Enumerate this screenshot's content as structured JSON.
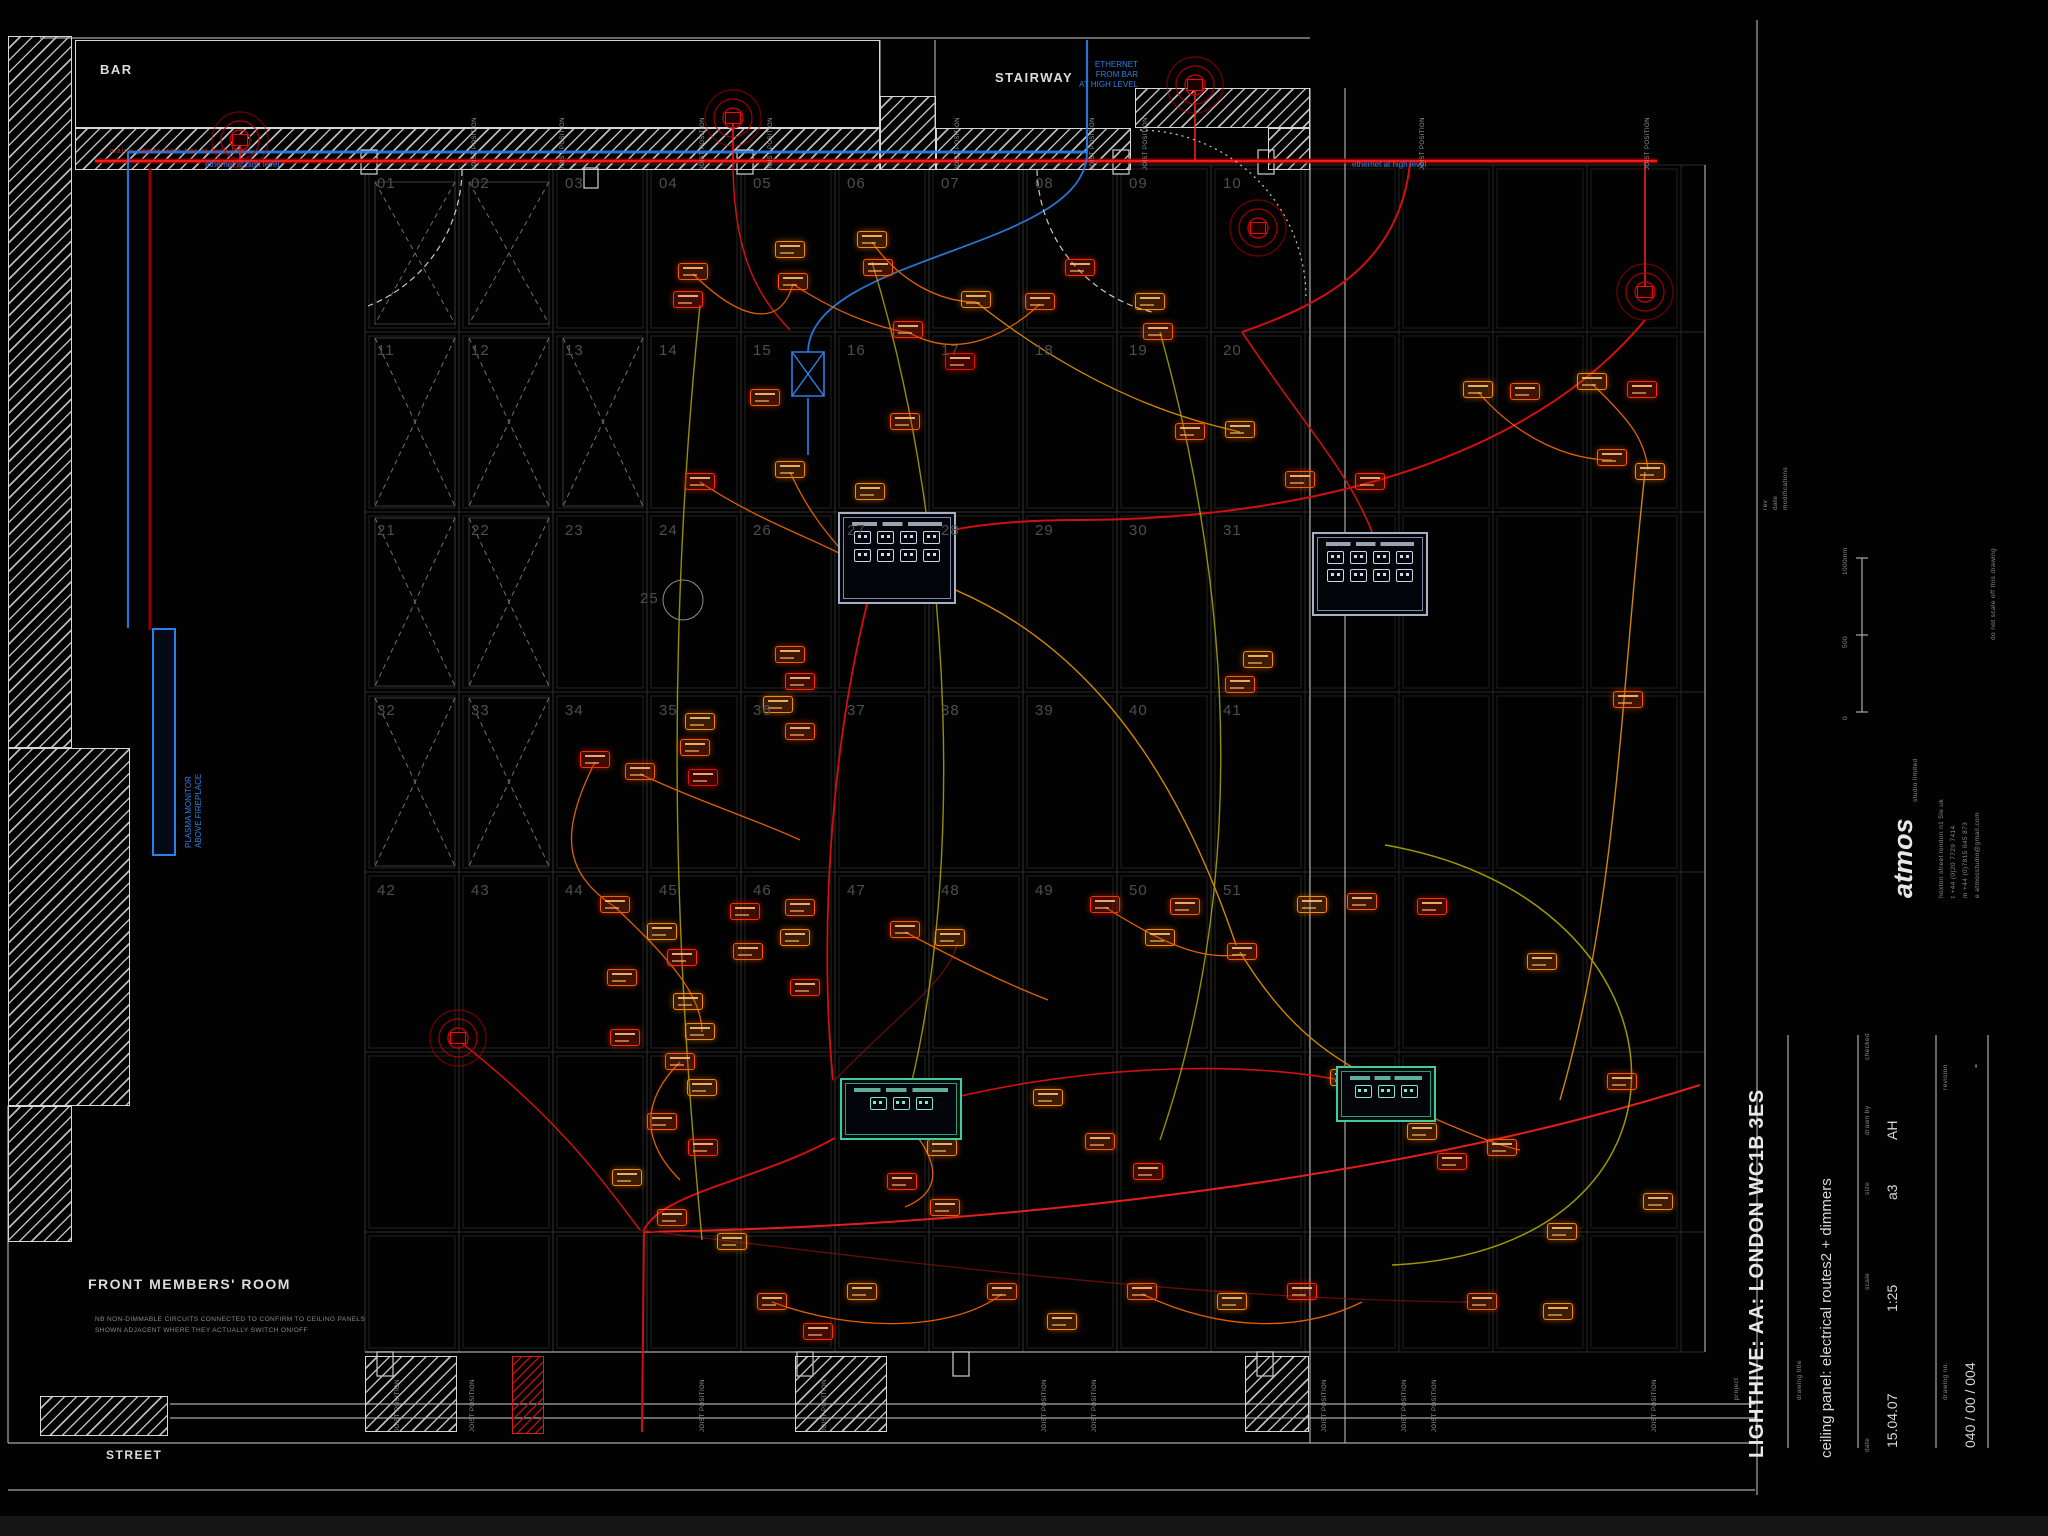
{
  "labels": {
    "bar": "BAR",
    "stairway": "STAIRWAY",
    "street": "STREET",
    "front_room": "FRONT MEMBERS' ROOM",
    "front_note1": "NB NON-DIMMABLE CIRCUITS CONNECTED TO CONFIRM TO CEILING PANELS",
    "front_note2": "SHOWN ADJACENT WHERE THEY ACTUALLY SWITCH ON/OFF",
    "plasma1": "PLASMA MONITOR",
    "plasma2": "ABOVE FIREPLACE",
    "eth_block": [
      "ETHERNET",
      "FROM BAR",
      "AT HIGH LEVEL"
    ],
    "eth_left": "ethernet at high level",
    "eth_right": "ethernet at high level",
    "mains_note": "mains power from bar at high level",
    "joist": "JOIST POSITION",
    "panel_25": "25"
  },
  "title_block": {
    "project_label": "project",
    "project": "LIGHTHIVE: AA: LONDON WC1B 3ES",
    "drawing_title_label": "drawing title",
    "drawing_title": "ceiling panel: electrical routes2 + dimmers",
    "date_label": "date",
    "date": "15.04.07",
    "scale_label": "scale",
    "scale": "1:25",
    "size_label": "size",
    "size": "a3",
    "drawn_label": "drawn by",
    "drawn": "AH",
    "checked_label": "checked",
    "checked": "",
    "drawing_no_label": "drawing no.",
    "drawing_no": "040 / 00 / 004",
    "revision_label": "revision",
    "revision": "-",
    "no_scale_note": "do not scale off this drawing",
    "margin_rev": "rev",
    "margin_date": "date",
    "margin_mods": "modifications",
    "logo_name": "atmos",
    "logo_sub": "studio limited",
    "logo_line1": "hoxton street  london  n1 5le  uk",
    "logo_line2": "t  +44 (0)20 7729 7414",
    "logo_line3": "m +44 (0)7815 045 873",
    "logo_line4": "e  atmosstudio@gmail.com",
    "scalebar_0": "0",
    "scalebar_500": "500",
    "scalebar_1000": "1000mm"
  },
  "palette": {
    "redMain": "#a00000",
    "redBright": "#ff2020",
    "red": "#d01010",
    "darkred": "#7a1010",
    "orange": "#e06000",
    "amber": "#d08800",
    "yellow": "#b0a800",
    "blue": "#2d7fe8",
    "dashWhite": "#c8c8c8"
  },
  "grid": {
    "x0": 365,
    "col_w": 94,
    "cols": 10,
    "row_ys": [
      165,
      332,
      512,
      692,
      872,
      1052,
      1232
    ],
    "bottom_y": 1352,
    "right_zone_xs": [
      1305,
      1399,
      1493,
      1587,
      1681
    ],
    "right_edge": 1705,
    "numbers": [
      [
        "01",
        "02",
        "03",
        "04",
        "05",
        "06",
        "07",
        "08",
        "09",
        "10"
      ],
      [
        "11",
        "12",
        "13",
        "14",
        "15",
        "16",
        "17",
        "18",
        "19",
        "20"
      ],
      [
        "21",
        "22",
        "23",
        "24",
        "26",
        "27",
        "28",
        "29",
        "30",
        "31"
      ],
      [
        "32",
        "33",
        "34",
        "35",
        "36",
        "37",
        "38",
        "39",
        "40",
        "41"
      ],
      [
        "42",
        "43",
        "44",
        "45",
        "46",
        "47",
        "48",
        "49",
        "50",
        "51"
      ]
    ]
  },
  "walls": [
    {
      "x": 8,
      "y": 36,
      "w": 64,
      "h": 712
    },
    {
      "x": 8,
      "y": 748,
      "w": 122,
      "h": 358
    },
    {
      "x": 8,
      "y": 1106,
      "w": 64,
      "h": 136
    },
    {
      "x": 75,
      "y": 128,
      "w": 805,
      "h": 42
    },
    {
      "x": 880,
      "y": 96,
      "w": 56,
      "h": 74
    },
    {
      "x": 936,
      "y": 128,
      "w": 195,
      "h": 42
    },
    {
      "x": 1135,
      "y": 88,
      "w": 175,
      "h": 40
    },
    {
      "x": 1268,
      "y": 128,
      "w": 42,
      "h": 42
    },
    {
      "x": 40,
      "y": 1396,
      "w": 128,
      "h": 40
    },
    {
      "x": 365,
      "y": 1356,
      "w": 92,
      "h": 76
    },
    {
      "x": 795,
      "y": 1356,
      "w": 92,
      "h": 76
    },
    {
      "x": 1245,
      "y": 1356,
      "w": 64,
      "h": 76
    }
  ],
  "red_walls": [
    {
      "x": 512,
      "y": 1356,
      "w": 32,
      "h": 78
    }
  ],
  "lines": [
    [
      40,
      38,
      1310,
      38
    ],
    [
      880,
      40,
      880,
      96
    ],
    [
      935,
      40,
      935,
      128
    ],
    [
      95,
      40,
      95,
      128
    ],
    [
      8,
      1106,
      8,
      1443
    ],
    [
      8,
      1443,
      1755,
      1443
    ],
    [
      8,
      1490,
      1755,
      1490
    ],
    [
      365,
      1352,
      1310,
      1352
    ],
    [
      170,
      1404,
      1755,
      1404
    ],
    [
      170,
      1418,
      1755,
      1418
    ],
    [
      1310,
      88,
      1310,
      1443
    ],
    [
      1345,
      88,
      1345,
      1443
    ],
    [
      1705,
      165,
      1705,
      1352
    ],
    [
      1757,
      20,
      1757,
      1495
    ],
    [
      1788,
      1035,
      1788,
      1448
    ],
    [
      1858,
      1035,
      1858,
      1448
    ],
    [
      1936,
      1035,
      1936,
      1448
    ],
    [
      1988,
      1035,
      1988,
      1448
    ],
    [
      1862,
      558,
      1862,
      712
    ],
    [
      1856,
      558,
      1868,
      558
    ],
    [
      1856,
      635,
      1868,
      635
    ],
    [
      1856,
      712,
      1868,
      712
    ]
  ],
  "wall_boxes": [
    [
      361,
      150,
      16,
      24
    ],
    [
      737,
      150,
      16,
      24
    ],
    [
      1113,
      150,
      16,
      24
    ],
    [
      1258,
      150,
      16,
      24
    ],
    [
      377,
      1352,
      16,
      24
    ],
    [
      797,
      1352,
      16,
      24
    ],
    [
      953,
      1352,
      16,
      24
    ],
    [
      1257,
      1352,
      16,
      24
    ],
    [
      584,
      168,
      14,
      20
    ]
  ],
  "xpanels": [
    [
      375,
      182,
      80,
      142
    ],
    [
      469,
      182,
      80,
      142
    ],
    [
      375,
      338,
      80,
      168
    ],
    [
      469,
      338,
      80,
      168
    ],
    [
      563,
      338,
      80,
      168
    ],
    [
      375,
      518,
      80,
      168
    ],
    [
      469,
      518,
      80,
      168
    ],
    [
      375,
      698,
      80,
      168
    ],
    [
      469,
      698,
      80,
      168
    ]
  ],
  "radials": [
    [
      240,
      140
    ],
    [
      733,
      118
    ],
    [
      1195,
      85
    ],
    [
      1258,
      228
    ],
    [
      1645,
      292
    ],
    [
      458,
      1038
    ]
  ],
  "circles": [
    [
      683,
      600,
      20
    ]
  ],
  "routes": [
    {
      "d": "M95,161 H1657",
      "c": "redMain",
      "w": 5,
      "o": 0.85
    },
    {
      "d": "M95,161 H1657",
      "c": "redBright",
      "w": 1.8
    },
    {
      "d": "M150,168 V630",
      "c": "redMain",
      "w": 3,
      "o": 0.9
    },
    {
      "d": "M128,152 H1087",
      "c": "blue",
      "w": 3,
      "o": 0.9
    },
    {
      "d": "M128,152 V628",
      "c": "blue",
      "w": 2.2,
      "o": 0.9
    },
    {
      "d": "M1087,40 V152",
      "c": "blue",
      "w": 2.2,
      "o": 0.9
    },
    {
      "d": "M1087,152 C1087,250 810,255 808,352",
      "c": "blue",
      "w": 1.8,
      "o": 0.9
    },
    {
      "d": "M808,398 V455",
      "c": "blue",
      "w": 1.8,
      "o": 0.9
    },
    {
      "d": "M792,352 h32 v44 h-32 Z",
      "c": "blue",
      "w": 1.6
    },
    {
      "d": "M792,352 L824,396 M824,352 L792,396",
      "c": "blue",
      "w": 1.4
    },
    {
      "d": "M240,142 V161",
      "c": "redBright",
      "w": 1.5
    },
    {
      "d": "M733,118 V161",
      "c": "redBright",
      "w": 1.5
    },
    {
      "d": "M1195,88 V161",
      "c": "redBright",
      "w": 1.5
    },
    {
      "d": "M1645,292 V161",
      "c": "redBright",
      "w": 1.5
    },
    {
      "d": "M1410,163 C1400,260 1330,302 1242,332",
      "c": "red",
      "w": 2
    },
    {
      "d": "M1645,320 C1500,495 1215,520 1080,520 C940,520 900,545 868,558",
      "c": "red",
      "w": 2
    },
    {
      "d": "M1242,332 C1300,420 1348,470 1372,532",
      "c": "red",
      "w": 1.6
    },
    {
      "d": "M868,600 C828,760 820,950 833,1080",
      "c": "red",
      "w": 1.8
    },
    {
      "d": "M835,1138 C760,1180 662,1192 644,1230 L642,1432",
      "c": "red",
      "w": 2
    },
    {
      "d": "M900,1112 C1080,1058 1290,1058 1385,1092",
      "c": "red",
      "w": 1.6
    },
    {
      "d": "M1700,1085 C1400,1180 1000,1226 645,1232",
      "c": "redBright",
      "w": 2,
      "o": 0.9
    },
    {
      "d": "M458,1040 C560,1120 602,1180 640,1230",
      "c": "red",
      "w": 1.5
    },
    {
      "d": "M733,161 C733,262 762,300 790,330",
      "c": "red",
      "w": 1.5
    },
    {
      "d": "M640,1230 C900,1262 1200,1300 1470,1302",
      "c": "darkred",
      "w": 1.3,
      "o": 0.8
    },
    {
      "d": "M833,1082 C900,1012 948,982 958,942",
      "c": "darkred",
      "w": 1.3,
      "o": 0.8
    },
    {
      "d": "M700,305 C660,700 680,1000 702,1240",
      "c": "yellow",
      "w": 1.4,
      "o": 0.85
    },
    {
      "d": "M872,262 C960,550 962,900 905,1108",
      "c": "yellow",
      "w": 1.4,
      "o": 0.85
    },
    {
      "d": "M1160,332 C1240,620 1242,900 1160,1140",
      "c": "yellow",
      "w": 1.4,
      "o": 0.85
    },
    {
      "d": "M1385,845 C1705,900 1720,1250 1392,1265",
      "c": "yellow",
      "w": 1.5,
      "o": 0.9
    },
    {
      "d": "M1240,952 C1300,1050 1350,1062 1392,1092",
      "c": "amber",
      "w": 1.4
    },
    {
      "d": "M860,562 C1080,600 1180,780 1236,945",
      "c": "amber",
      "w": 1.4
    },
    {
      "d": "M1645,472 C1620,700 1618,900 1560,1100",
      "c": "amber",
      "w": 1.4
    },
    {
      "d": "M976,302 C1100,400 1198,422 1240,432",
      "c": "amber",
      "w": 1.3
    },
    {
      "d": "M693,274 C740,320 780,330 793,284",
      "c": "orange",
      "w": 1.3
    },
    {
      "d": "M793,284 C850,322 900,332 908,332",
      "c": "orange",
      "w": 1.3
    },
    {
      "d": "M908,332 C960,362 1010,332 1040,304",
      "c": "orange",
      "w": 1.3
    },
    {
      "d": "M872,242 C900,282 940,302 976,302",
      "c": "orange",
      "w": 1.3
    },
    {
      "d": "M700,482 C760,522 822,542 848,558",
      "c": "orange",
      "w": 1.3
    },
    {
      "d": "M640,774 C700,802 762,822 800,840",
      "c": "orange",
      "w": 1.3
    },
    {
      "d": "M615,907 C662,952 702,992 702,1032",
      "c": "orange",
      "w": 1.3
    },
    {
      "d": "M905,932 C962,962 1002,982 1048,1000",
      "c": "orange",
      "w": 1.3
    },
    {
      "d": "M1105,907 C1160,942 1202,962 1242,954",
      "c": "orange",
      "w": 1.3
    },
    {
      "d": "M1345,1080 C1422,1112 1482,1142 1520,1150",
      "c": "orange",
      "w": 1.3
    },
    {
      "d": "M772,1302 C852,1332 952,1332 1002,1294",
      "c": "orange",
      "w": 1.3
    },
    {
      "d": "M1142,1294 C1222,1332 1302,1332 1362,1302",
      "c": "orange",
      "w": 1.3
    },
    {
      "d": "M595,762 C560,832 562,872 615,907",
      "c": "orange",
      "w": 1.3
    },
    {
      "d": "M680,1062 C640,1102 642,1142 680,1180",
      "c": "orange",
      "w": 1.3
    },
    {
      "d": "M905,1122 C942,1162 942,1192 905,1207",
      "c": "orange",
      "w": 1.3
    },
    {
      "d": "M790,472 C812,520 834,540 846,556",
      "c": "orange",
      "w": 1.3
    },
    {
      "d": "M1478,392 C1520,440 1570,460 1612,460",
      "c": "orange",
      "w": 1.3
    },
    {
      "d": "M1592,384 C1630,420 1645,440 1648,470",
      "c": "orange",
      "w": 1.3
    },
    {
      "d": "M462,170 A148,148 0 0 1 368,306",
      "c": "dashWhite",
      "w": 1.2,
      "dash": "6,4"
    },
    {
      "d": "M1037,170 A150,150 0 0 0 1152,312",
      "c": "dashWhite",
      "w": 1.2,
      "dash": "6,4"
    },
    {
      "d": "M1140,130 A168,168 0 0 1 1306,296",
      "c": "dashWhite",
      "w": 1.2,
      "dash": "2,4"
    }
  ],
  "fixtures": [
    [
      693,
      272,
      1
    ],
    [
      688,
      300,
      2
    ],
    [
      790,
      250,
      0
    ],
    [
      793,
      282,
      1
    ],
    [
      872,
      240,
      0
    ],
    [
      878,
      268,
      1
    ],
    [
      908,
      330,
      2
    ],
    [
      976,
      300,
      0
    ],
    [
      1040,
      302,
      1
    ],
    [
      960,
      362,
      3
    ],
    [
      1080,
      268,
      2
    ],
    [
      1150,
      302,
      0
    ],
    [
      1158,
      332,
      1
    ],
    [
      1240,
      430,
      0
    ],
    [
      1190,
      432,
      1
    ],
    [
      1478,
      390,
      0
    ],
    [
      1525,
      392,
      1
    ],
    [
      1592,
      382,
      0
    ],
    [
      1642,
      390,
      2
    ],
    [
      1612,
      458,
      1
    ],
    [
      1650,
      472,
      0
    ],
    [
      1370,
      482,
      2
    ],
    [
      1300,
      480,
      1
    ],
    [
      595,
      760,
      2
    ],
    [
      640,
      772,
      1
    ],
    [
      700,
      722,
      0
    ],
    [
      695,
      748,
      1
    ],
    [
      703,
      778,
      3
    ],
    [
      790,
      655,
      1
    ],
    [
      800,
      682,
      2
    ],
    [
      778,
      705,
      0
    ],
    [
      800,
      732,
      1
    ],
    [
      745,
      912,
      2
    ],
    [
      800,
      908,
      1
    ],
    [
      795,
      938,
      0
    ],
    [
      748,
      952,
      1
    ],
    [
      805,
      988,
      2
    ],
    [
      700,
      1032,
      0
    ],
    [
      615,
      905,
      1
    ],
    [
      662,
      932,
      0
    ],
    [
      682,
      958,
      2
    ],
    [
      622,
      978,
      1
    ],
    [
      688,
      1002,
      0
    ],
    [
      905,
      930,
      1
    ],
    [
      950,
      938,
      0
    ],
    [
      1105,
      905,
      2
    ],
    [
      1185,
      907,
      1
    ],
    [
      1160,
      938,
      0
    ],
    [
      1242,
      952,
      1
    ],
    [
      1312,
      905,
      0
    ],
    [
      1362,
      902,
      1
    ],
    [
      1432,
      907,
      2
    ],
    [
      1542,
      962,
      0
    ],
    [
      1628,
      700,
      1
    ],
    [
      1258,
      660,
      0
    ],
    [
      1240,
      685,
      1
    ],
    [
      625,
      1038,
      2
    ],
    [
      680,
      1062,
      1
    ],
    [
      702,
      1088,
      0
    ],
    [
      662,
      1122,
      1
    ],
    [
      703,
      1148,
      2
    ],
    [
      627,
      1178,
      0
    ],
    [
      672,
      1218,
      1
    ],
    [
      732,
      1242,
      0
    ],
    [
      905,
      1122,
      1
    ],
    [
      942,
      1148,
      0
    ],
    [
      902,
      1182,
      2
    ],
    [
      945,
      1208,
      1
    ],
    [
      1048,
      1098,
      0
    ],
    [
      1100,
      1142,
      1
    ],
    [
      1148,
      1172,
      2
    ],
    [
      1345,
      1078,
      0
    ],
    [
      1395,
      1092,
      1
    ],
    [
      1422,
      1132,
      0
    ],
    [
      1452,
      1162,
      2
    ],
    [
      1502,
      1148,
      1
    ],
    [
      1562,
      1232,
      0
    ],
    [
      1622,
      1082,
      1
    ],
    [
      1658,
      1202,
      0
    ],
    [
      772,
      1302,
      1
    ],
    [
      818,
      1332,
      2
    ],
    [
      862,
      1292,
      0
    ],
    [
      1002,
      1292,
      1
    ],
    [
      1062,
      1322,
      0
    ],
    [
      1142,
      1292,
      1
    ],
    [
      1232,
      1302,
      0
    ],
    [
      1302,
      1292,
      2
    ],
    [
      1482,
      1302,
      1
    ],
    [
      1558,
      1312,
      0
    ],
    [
      765,
      398,
      1
    ],
    [
      905,
      422,
      1
    ],
    [
      790,
      470,
      0
    ],
    [
      700,
      482,
      2
    ],
    [
      870,
      492,
      0
    ]
  ],
  "panels": [
    {
      "x": 838,
      "y": 512,
      "w": 118,
      "h": 92,
      "style": "grey",
      "rows": [
        4,
        4
      ]
    },
    {
      "x": 1312,
      "y": 532,
      "w": 116,
      "h": 84,
      "style": "grey",
      "rows": [
        4,
        4
      ]
    },
    {
      "x": 840,
      "y": 1078,
      "w": 122,
      "h": 62,
      "style": "teal",
      "rows": [
        3
      ]
    },
    {
      "x": 1336,
      "y": 1066,
      "w": 100,
      "h": 56,
      "style": "teal",
      "rows": [
        3
      ]
    }
  ],
  "joists": {
    "top": [
      472,
      560,
      700,
      768,
      955,
      1090,
      1143,
      1420,
      1645
    ],
    "bottom": [
      395,
      470,
      700,
      822,
      1042,
      1092,
      1322,
      1402,
      1432,
      1652
    ]
  }
}
